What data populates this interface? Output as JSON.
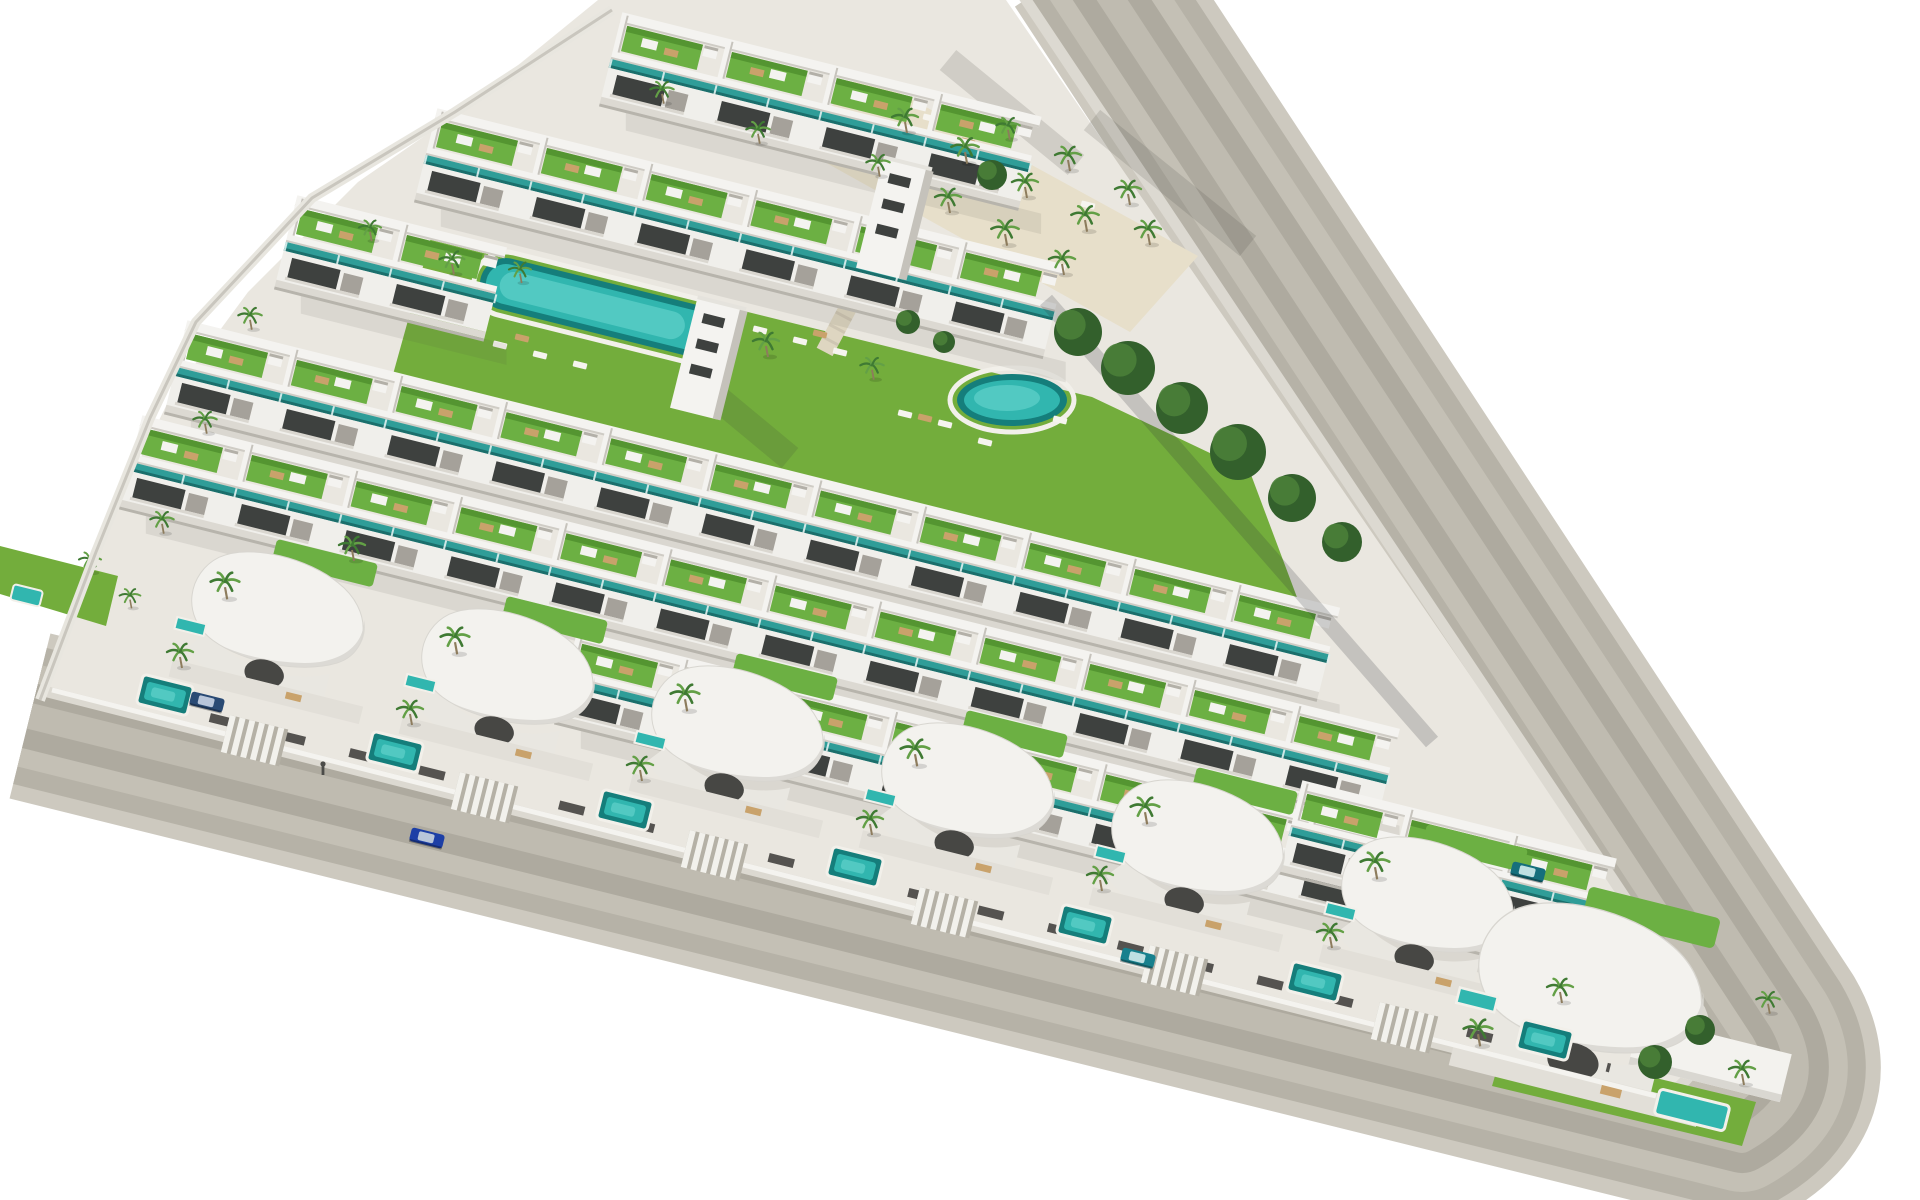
{
  "meta": {
    "type": "architectural-aerial-render",
    "subject": "triangular-residential-development"
  },
  "palette": {
    "background": "#ffffff",
    "site_base": "#eae7e0",
    "sand": "#e7dfca",
    "road_band1": "#cdc9bf",
    "road_band2": "#b6b2a7",
    "road_band3": "#c4c0b5",
    "road_band4": "#aeaa9f",
    "road_band5": "#bfbbb0",
    "sidewalk": "#dcd9d1",
    "wall_white": "#f4f3f0",
    "wall_shade": "#d9d7d1",
    "wall_gray": "#a5a19a",
    "facade": "#f0efeb",
    "window_dark": "#3e413f",
    "glass_teal": "#2f9d98",
    "glass_teal_dark": "#1b6f6c",
    "pool_dark": "#157e7b",
    "pool_mid": "#31b6af",
    "pool_light": "#58cdc5",
    "lawn": "#73ad3c",
    "roof_green": "#6cb043",
    "roof_green_dark": "#549531",
    "tree_dark": "#33602c",
    "tree_light": "#4a8038",
    "palm_frond": "#3f7a33",
    "palm_frond_light": "#63a046",
    "trunk": "#8d7c5d",
    "furniture_tan": "#c9a26b",
    "stair_sand": "#ded6c1",
    "fence_dark": "#403f3b",
    "shadow_soft": "rgba(80,78,70,0.10)",
    "shadow_streak": "rgba(60,58,52,0.15)",
    "tree_shadow": "rgba(45,50,55,0.20)"
  },
  "scene": {
    "canvas": {
      "w": 1920,
      "h": 1200
    },
    "angles": {
      "row_rot": 14,
      "stair_rot": 28,
      "shadow_skew": 14
    },
    "road": {
      "path": "M 1086,-40 L 1781,1020 Q 1824,1094 1742,1140 L 30,716",
      "bands": [
        {
          "width": 170,
          "color_key": "road_band1"
        },
        {
          "width": 140,
          "color_key": "road_band2"
        },
        {
          "width": 104,
          "color_key": "road_band3"
        },
        {
          "width": 66,
          "color_key": "road_band4"
        },
        {
          "width": 26,
          "color_key": "road_band5"
        }
      ]
    },
    "site": {
      "path": "M 598,0 L 1006,0 L 1700,1010 Q 1722,1062 1660,1100 L 40,690 L 96,548 L 170,398 L 248,292 L 358,182 L 468,106 Z",
      "sidewalk_path": "M 1006,-30 L 1700,1010 Q 1722,1062 1660,1100 L 40,690",
      "boundary_wall_points": "612,10 455,112 312,198 196,322 150,418 96,552 40,700"
    },
    "sand_garden": {
      "points": "862,72 1198,256 1130,332 796,146"
    },
    "lawns": [
      {
        "name": "amenity-lawn",
        "points": "432,234 1092,397 1250,472 1298,600 392,378"
      },
      {
        "name": "left-lawn",
        "points": "0,546 118,576 106,626 0,594"
      },
      {
        "name": "corner-lawn",
        "points": "1505,1042 1756,1102 1742,1146 1492,1086"
      }
    ],
    "pools": {
      "kidney": {
        "cx": 602,
        "cy": 308,
        "w": 250,
        "h": 52
      },
      "round": {
        "cx": 1012,
        "cy": 400,
        "rx": 55,
        "ry": 26
      },
      "left_sliver": {
        "x": 14,
        "y": 584,
        "w": 30,
        "h": 16
      },
      "corner": {
        "x": 1692,
        "y": 1110,
        "w": 72,
        "h": 26
      },
      "plunge": [
        [
          165,
          695
        ],
        [
          395,
          752
        ],
        [
          625,
          810
        ],
        [
          855,
          867
        ],
        [
          1085,
          925
        ],
        [
          1315,
          982
        ],
        [
          1545,
          1040
        ]
      ]
    },
    "stair_path": {
      "x": 849,
      "y": 306,
      "w": 18,
      "h": 104
    },
    "rows": [
      {
        "name": "terrace-row-a",
        "x": 620,
        "y": 22,
        "units": 4
      },
      {
        "name": "terrace-row-b",
        "x": 435,
        "y": 118,
        "units": 6
      },
      {
        "name": "terrace-row-c",
        "x": 295,
        "y": 205,
        "units": 2
      },
      {
        "name": "terrace-row-d",
        "x": 185,
        "y": 330,
        "units": 11
      },
      {
        "name": "terrace-row-e",
        "x": 140,
        "y": 425,
        "units": 12
      },
      {
        "name": "terrace-row-f",
        "x": 575,
        "y": 640,
        "units": 9
      },
      {
        "name": "terrace-row-g",
        "x": 1300,
        "y": 790,
        "units": 3
      }
    ],
    "unit_width": 108,
    "towers": [
      [
        686,
        352
      ],
      [
        872,
        212
      ]
    ],
    "villas": [
      {
        "x": 285,
        "y": 615,
        "s": 1
      },
      {
        "x": 515,
        "y": 672,
        "s": 1
      },
      {
        "x": 745,
        "y": 729,
        "s": 1
      },
      {
        "x": 975,
        "y": 786,
        "s": 1
      },
      {
        "x": 1205,
        "y": 843,
        "s": 1
      },
      {
        "x": 1435,
        "y": 900,
        "s": 1
      },
      {
        "x": 1600,
        "y": 985,
        "s": 1.3,
        "wing": true
      }
    ],
    "driveways": [
      [
        230,
        715
      ],
      [
        460,
        772
      ],
      [
        690,
        830
      ],
      [
        920,
        887
      ],
      [
        1150,
        945
      ],
      [
        1380,
        1002
      ]
    ],
    "frontage": {
      "white_wall_path": "M 52,690 L 1656,1096",
      "fence_path": "M 140,700 L 1610,1068"
    },
    "shadow_streaks": [
      [
        948,
        60,
        1076,
        165
      ],
      [
        1092,
        120,
        1248,
        246
      ],
      [
        690,
        375,
        790,
        458
      ]
    ],
    "tree_line_shadow": [
      1046,
      300,
      1432,
      742
    ],
    "loungers_white": [
      [
        500,
        345
      ],
      [
        540,
        355
      ],
      [
        580,
        365
      ],
      [
        760,
        330
      ],
      [
        800,
        341
      ],
      [
        840,
        352
      ],
      [
        905,
        414
      ],
      [
        945,
        424
      ],
      [
        1060,
        420
      ],
      [
        985,
        442
      ],
      [
        930,
        118
      ],
      [
        1010,
        162
      ],
      [
        1088,
        205
      ]
    ],
    "loungers_tan": [
      [
        522,
        338
      ],
      [
        820,
        334
      ],
      [
        925,
        418
      ],
      [
        968,
        142
      ]
    ],
    "trees": [
      [
        1078,
        332,
        24
      ],
      [
        1128,
        368,
        27
      ],
      [
        1182,
        408,
        26
      ],
      [
        1238,
        452,
        28
      ],
      [
        1292,
        498,
        24
      ],
      [
        1342,
        542,
        20
      ],
      [
        992,
        175,
        15
      ],
      [
        1655,
        1062,
        17
      ],
      [
        1700,
        1030,
        15
      ],
      [
        908,
        322,
        12
      ],
      [
        944,
        342,
        11
      ]
    ],
    "palms": [
      [
        662,
        92,
        0.9
      ],
      [
        758,
        132,
        0.9
      ],
      [
        905,
        120,
        1
      ],
      [
        965,
        150,
        1.05
      ],
      [
        1025,
        185,
        1
      ],
      [
        1085,
        218,
        1.05
      ],
      [
        1008,
        128,
        0.9
      ],
      [
        1068,
        158,
        1
      ],
      [
        1128,
        192,
        1
      ],
      [
        948,
        200,
        1
      ],
      [
        1005,
        232,
        1.05
      ],
      [
        1148,
        232,
        1
      ],
      [
        878,
        165,
        0.9
      ],
      [
        1062,
        262,
        1
      ],
      [
        370,
        230,
        0.85
      ],
      [
        520,
        272,
        0.85
      ],
      [
        452,
        262,
        0.95
      ],
      [
        766,
        344,
        1
      ],
      [
        872,
        368,
        0.9
      ],
      [
        250,
        318,
        0.9
      ],
      [
        205,
        422,
        0.9
      ],
      [
        162,
        522,
        0.9
      ],
      [
        352,
        548,
        1
      ],
      [
        225,
        585,
        1.1
      ],
      [
        455,
        640,
        1.1
      ],
      [
        685,
        697,
        1.1
      ],
      [
        915,
        752,
        1.1
      ],
      [
        1145,
        810,
        1.1
      ],
      [
        1375,
        865,
        1.1
      ],
      [
        180,
        655,
        1
      ],
      [
        410,
        712,
        1
      ],
      [
        640,
        768,
        1
      ],
      [
        870,
        822,
        1
      ],
      [
        1100,
        878,
        1
      ],
      [
        1330,
        935,
        1
      ],
      [
        1560,
        990,
        1
      ],
      [
        1478,
        1032,
        1.1
      ],
      [
        1742,
        1072,
        1
      ],
      [
        1768,
        1002,
        0.9
      ],
      [
        90,
        562,
        0.85
      ],
      [
        130,
        598,
        0.8
      ]
    ],
    "cars": [
      {
        "name": "car-blue-on-road",
        "x": 427,
        "y": 838,
        "body": "#1d3fa6",
        "glass": "#b9c6da"
      },
      {
        "name": "car-navy-driveway",
        "x": 207,
        "y": 702,
        "body": "#2a4a74",
        "glass": "#b9c6da"
      },
      {
        "name": "car-teal-driveway",
        "x": 1138,
        "y": 958,
        "body": "#17808d",
        "glass": "#bfe0e2"
      },
      {
        "name": "car-teal-driveway-2",
        "x": 1528,
        "y": 872,
        "body": "#156f7c",
        "glass": "#bfe0e2"
      }
    ],
    "people": [
      [
        323,
        772
      ]
    ]
  }
}
